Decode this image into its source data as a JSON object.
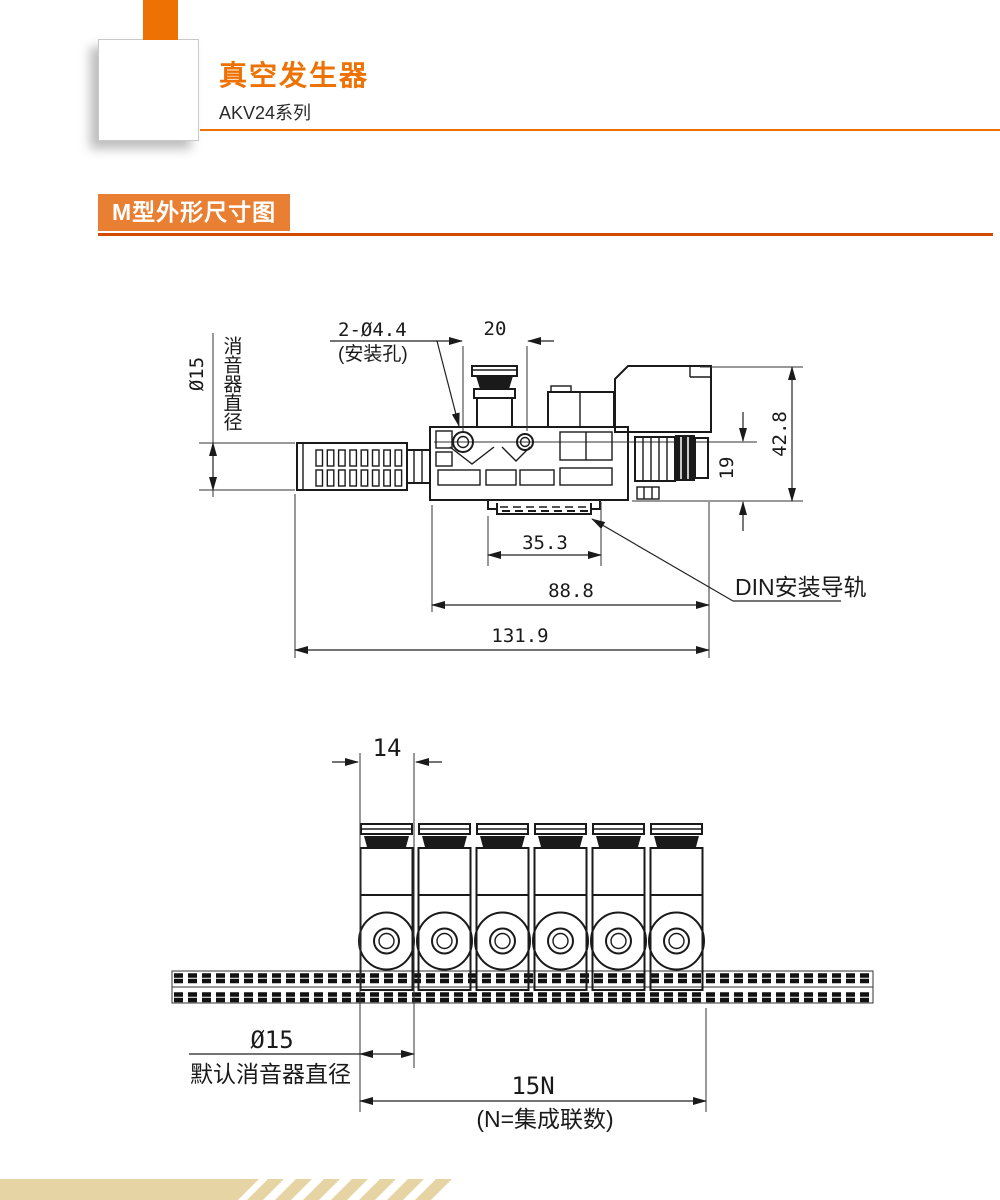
{
  "header": {
    "title": "真空发生器",
    "series": "AKV24系列"
  },
  "section": {
    "badge": "M型外形尺寸图"
  },
  "side_view": {
    "muffler_diameter": "Ø15",
    "muffler_diameter_note": "消音器直径",
    "mounting_holes": "2-Ø4.4",
    "mounting_holes_note": "(安装孔)",
    "hole_spacing": "20",
    "overall_height": "42.8",
    "rail_to_center": "19",
    "rail_slot_width": "35.3",
    "body_length": "88.8",
    "overall_length": "131.9",
    "din_rail_label": "DIN安装导轨"
  },
  "front_view": {
    "station_pitch": "14",
    "muffler_diameter": "Ø15",
    "muffler_diameter_note": "默认消音器直径",
    "total_width": "15N",
    "total_width_note": "(N=集成联数)",
    "module_count": "6"
  },
  "colors": {
    "accent": "#ee7203",
    "badge_bg": "#e87f33",
    "badge_rule": "#d14a00",
    "footer_band": "#e7d4a4",
    "line": "#1a1a1a"
  }
}
